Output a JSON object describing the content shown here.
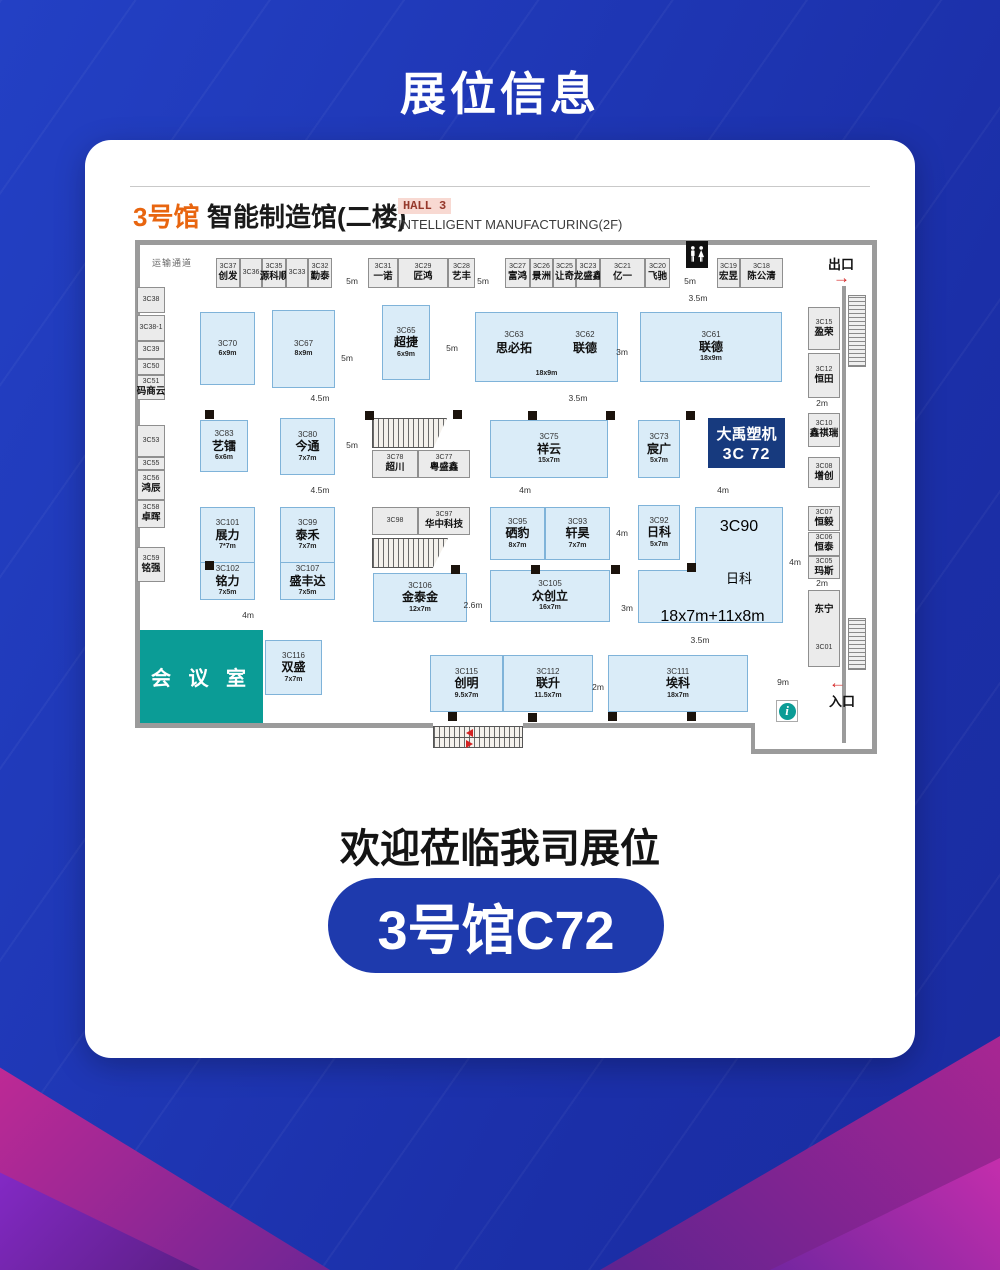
{
  "page": {
    "title": "展位信息",
    "welcome": "欢迎莅临我司展位",
    "booth_cta": "3号馆C72"
  },
  "header": {
    "hall_no": "3号馆",
    "hall_name": "智能制造馆(二楼)",
    "hall_en_tag": "HALL 3",
    "hall_en": "INTELLIGENT MANUFACTURING(2F)"
  },
  "plan": {
    "corridor": "运输通道",
    "exit": "出口",
    "entrance": "入口",
    "meeting_room": "会 议 室",
    "exit_arrow": "→",
    "entrance_arrow": "←",
    "info_glyph": "i",
    "highlight": {
      "name": "大禹塑机",
      "code": "3C 72"
    },
    "top_row": [
      {
        "code": "3C37",
        "name": "创发"
      },
      {
        "code": "3C36"
      },
      {
        "code": "3C35",
        "name": "源科顺"
      },
      {
        "code": "3C33"
      },
      {
        "code": "3C32",
        "name": "勤泰"
      },
      {
        "code": "3C31",
        "name": "一诺"
      },
      {
        "code": "3C29",
        "name": "匠鸿"
      },
      {
        "code": "3C28",
        "name": "艺丰"
      },
      {
        "code": "3C27",
        "name": "富鸿"
      },
      {
        "code": "3C26",
        "name": "景洲"
      },
      {
        "code": "3C25",
        "name": "让奇"
      },
      {
        "code": "3C23",
        "name": "龙盛鑫"
      },
      {
        "code": "3C21",
        "name": "亿一"
      },
      {
        "code": "3C20",
        "name": "飞驰"
      },
      {
        "code": "3C19",
        "name": "宏昱"
      },
      {
        "code": "3C18",
        "name": "陈公清"
      }
    ],
    "left_col": [
      {
        "code": "3C38"
      },
      {
        "code": "3C38-1"
      },
      {
        "code": "3C39"
      },
      {
        "code": "3C50"
      },
      {
        "code": "3C51",
        "name": "码商云"
      },
      {
        "code": "3C53"
      },
      {
        "code": "3C55"
      },
      {
        "code": "3C56",
        "name": "鸿辰"
      },
      {
        "code": "3C58",
        "name": "卓晖"
      },
      {
        "code": "3C59",
        "name": "铭强"
      }
    ],
    "right_col": [
      {
        "code": "3C15",
        "name": "盈荣"
      },
      {
        "code": "3C12",
        "name": "恒田"
      },
      {
        "code": "3C10",
        "name": "鑫祺瑞"
      },
      {
        "code": "3C08",
        "name": "增创"
      },
      {
        "code": "3C07",
        "name": "恒毅"
      },
      {
        "code": "3C06",
        "name": "恒泰"
      },
      {
        "code": "3C05",
        "name": "玛斯"
      },
      {
        "code": "3C01",
        "name": "东宁"
      }
    ],
    "floor": [
      {
        "code": "3C70",
        "dims": "6x9m"
      },
      {
        "code": "3C67",
        "dims": "8x9m"
      },
      {
        "code": "3C65",
        "name": "超捷",
        "dims": "6x9m"
      },
      {
        "code": "3C63",
        "name": "思必拓"
      },
      {
        "code": "3C62",
        "name": "联德",
        "dims": "18x9m"
      },
      {
        "code": "3C61",
        "name": "联德",
        "dims": "18x9m"
      },
      {
        "code": "3C83",
        "name": "艺镭",
        "dims": "6x6m"
      },
      {
        "code": "3C80",
        "name": "今通",
        "dims": "7x7m"
      },
      {
        "code": "3C78",
        "name": "超川"
      },
      {
        "code": "3C77",
        "name": "粤盛鑫"
      },
      {
        "code": "3C75",
        "name": "祥云",
        "dims": "15x7m"
      },
      {
        "code": "3C73",
        "name": "宸广",
        "dims": "5x7m"
      },
      {
        "code": "3C101",
        "name": "展力",
        "dims": "7*7m"
      },
      {
        "code": "3C102",
        "name": "铭力",
        "dims": "7x5m"
      },
      {
        "code": "3C99",
        "name": "泰禾",
        "dims": "7x7m"
      },
      {
        "code": "3C107",
        "name": "盛丰达",
        "dims": "7x5m"
      },
      {
        "code": "3C98"
      },
      {
        "code": "3C97",
        "name": "华中科技"
      },
      {
        "code": "3C95",
        "name": "硒豹",
        "dims": "8x7m"
      },
      {
        "code": "3C93",
        "name": "轩昊",
        "dims": "7x7m"
      },
      {
        "code": "3C92",
        "name": "日科",
        "dims": "5x7m"
      },
      {
        "code": "3C90",
        "name": "日科",
        "dims": "18x7m+11x8m"
      },
      {
        "code": "3C106",
        "name": "金泰金",
        "dims": "12x7m"
      },
      {
        "code": "3C105",
        "name": "众创立",
        "dims": "16x7m"
      },
      {
        "code": "3C116",
        "name": "双盛",
        "dims": "7x7m"
      },
      {
        "code": "3C115",
        "name": "创明",
        "dims": "9.5x7m"
      },
      {
        "code": "3C112",
        "name": "联升",
        "dims": "11.5x7m"
      },
      {
        "code": "3C111",
        "name": "埃科",
        "dims": "18x7m"
      }
    ],
    "measures": [
      "5m",
      "5m",
      "5m",
      "3.5m",
      "5m",
      "5m",
      "3m",
      "4.5m",
      "3.5m",
      "2m",
      "5m",
      "4.5m",
      "4m",
      "4m",
      "4m",
      "4m",
      "4m",
      "2.6m",
      "3m",
      "3.5m",
      "2m",
      "9m",
      "2m"
    ]
  },
  "colors": {
    "page_bg": "#1e34b2",
    "accent_orange": "#e8650f",
    "booth_fill": "#daecf8",
    "booth_border": "#7fb3d9",
    "highlight_navy": "#173a7e",
    "teal": "#0b9c96",
    "red": "#d42222",
    "pill_blue": "#1e3aad"
  }
}
